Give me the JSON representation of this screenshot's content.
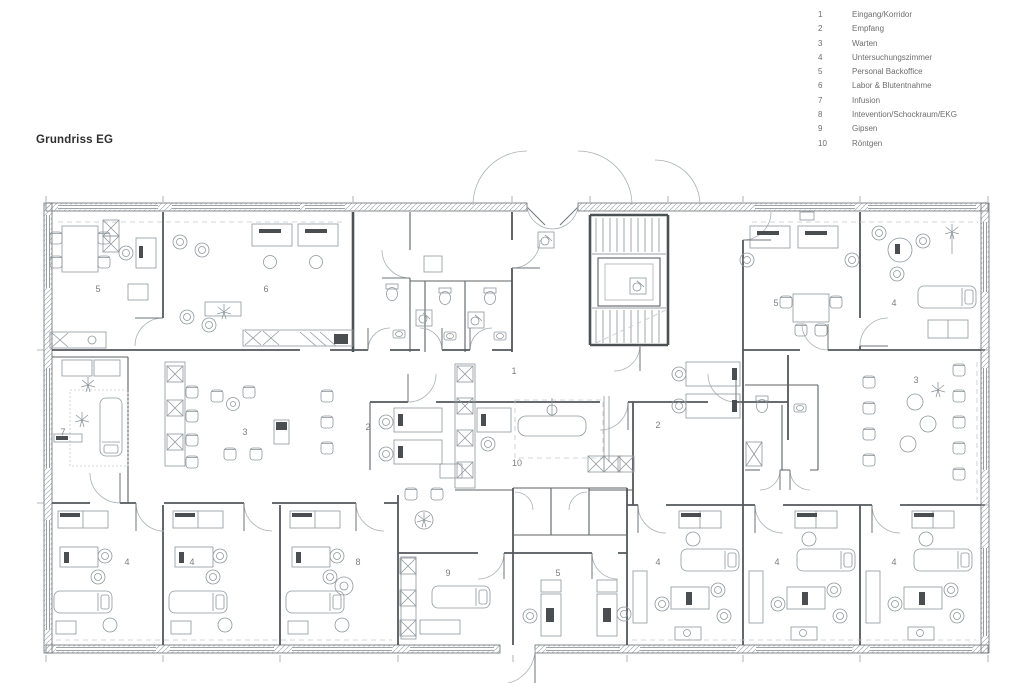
{
  "title": "Grundriss EG",
  "legend": {
    "items": [
      {
        "num": "1",
        "label": "Eingang/Korridor"
      },
      {
        "num": "2",
        "label": "Empfang"
      },
      {
        "num": "3",
        "label": "Warten"
      },
      {
        "num": "4",
        "label": "Untersuchungszimmer"
      },
      {
        "num": "5",
        "label": "Personal Backoffice"
      },
      {
        "num": "6",
        "label": "Labor & Blutentnahme"
      },
      {
        "num": "7",
        "label": "Infusion"
      },
      {
        "num": "8",
        "label": "Intevention/Schockraum/EKG"
      },
      {
        "num": "9",
        "label": "Gipsen"
      },
      {
        "num": "10",
        "label": "Röntgen"
      }
    ]
  },
  "plan": {
    "room_labels": [
      {
        "text": "5",
        "x": 98,
        "y": 292
      },
      {
        "text": "6",
        "x": 266,
        "y": 292
      },
      {
        "text": "5",
        "x": 776,
        "y": 306
      },
      {
        "text": "4",
        "x": 894,
        "y": 306
      },
      {
        "text": "1",
        "x": 514,
        "y": 374
      },
      {
        "text": "7",
        "x": 63,
        "y": 435
      },
      {
        "text": "3",
        "x": 245,
        "y": 435
      },
      {
        "text": "2",
        "x": 368,
        "y": 430
      },
      {
        "text": "10",
        "x": 517,
        "y": 466
      },
      {
        "text": "2",
        "x": 658,
        "y": 428
      },
      {
        "text": "3",
        "x": 916,
        "y": 383
      },
      {
        "text": "4",
        "x": 127,
        "y": 565
      },
      {
        "text": "4",
        "x": 192,
        "y": 565
      },
      {
        "text": "8",
        "x": 358,
        "y": 565
      },
      {
        "text": "9",
        "x": 448,
        "y": 576
      },
      {
        "text": "5",
        "x": 558,
        "y": 576
      },
      {
        "text": "4",
        "x": 658,
        "y": 565
      },
      {
        "text": "4",
        "x": 777,
        "y": 565
      },
      {
        "text": "4",
        "x": 894,
        "y": 565
      }
    ]
  }
}
